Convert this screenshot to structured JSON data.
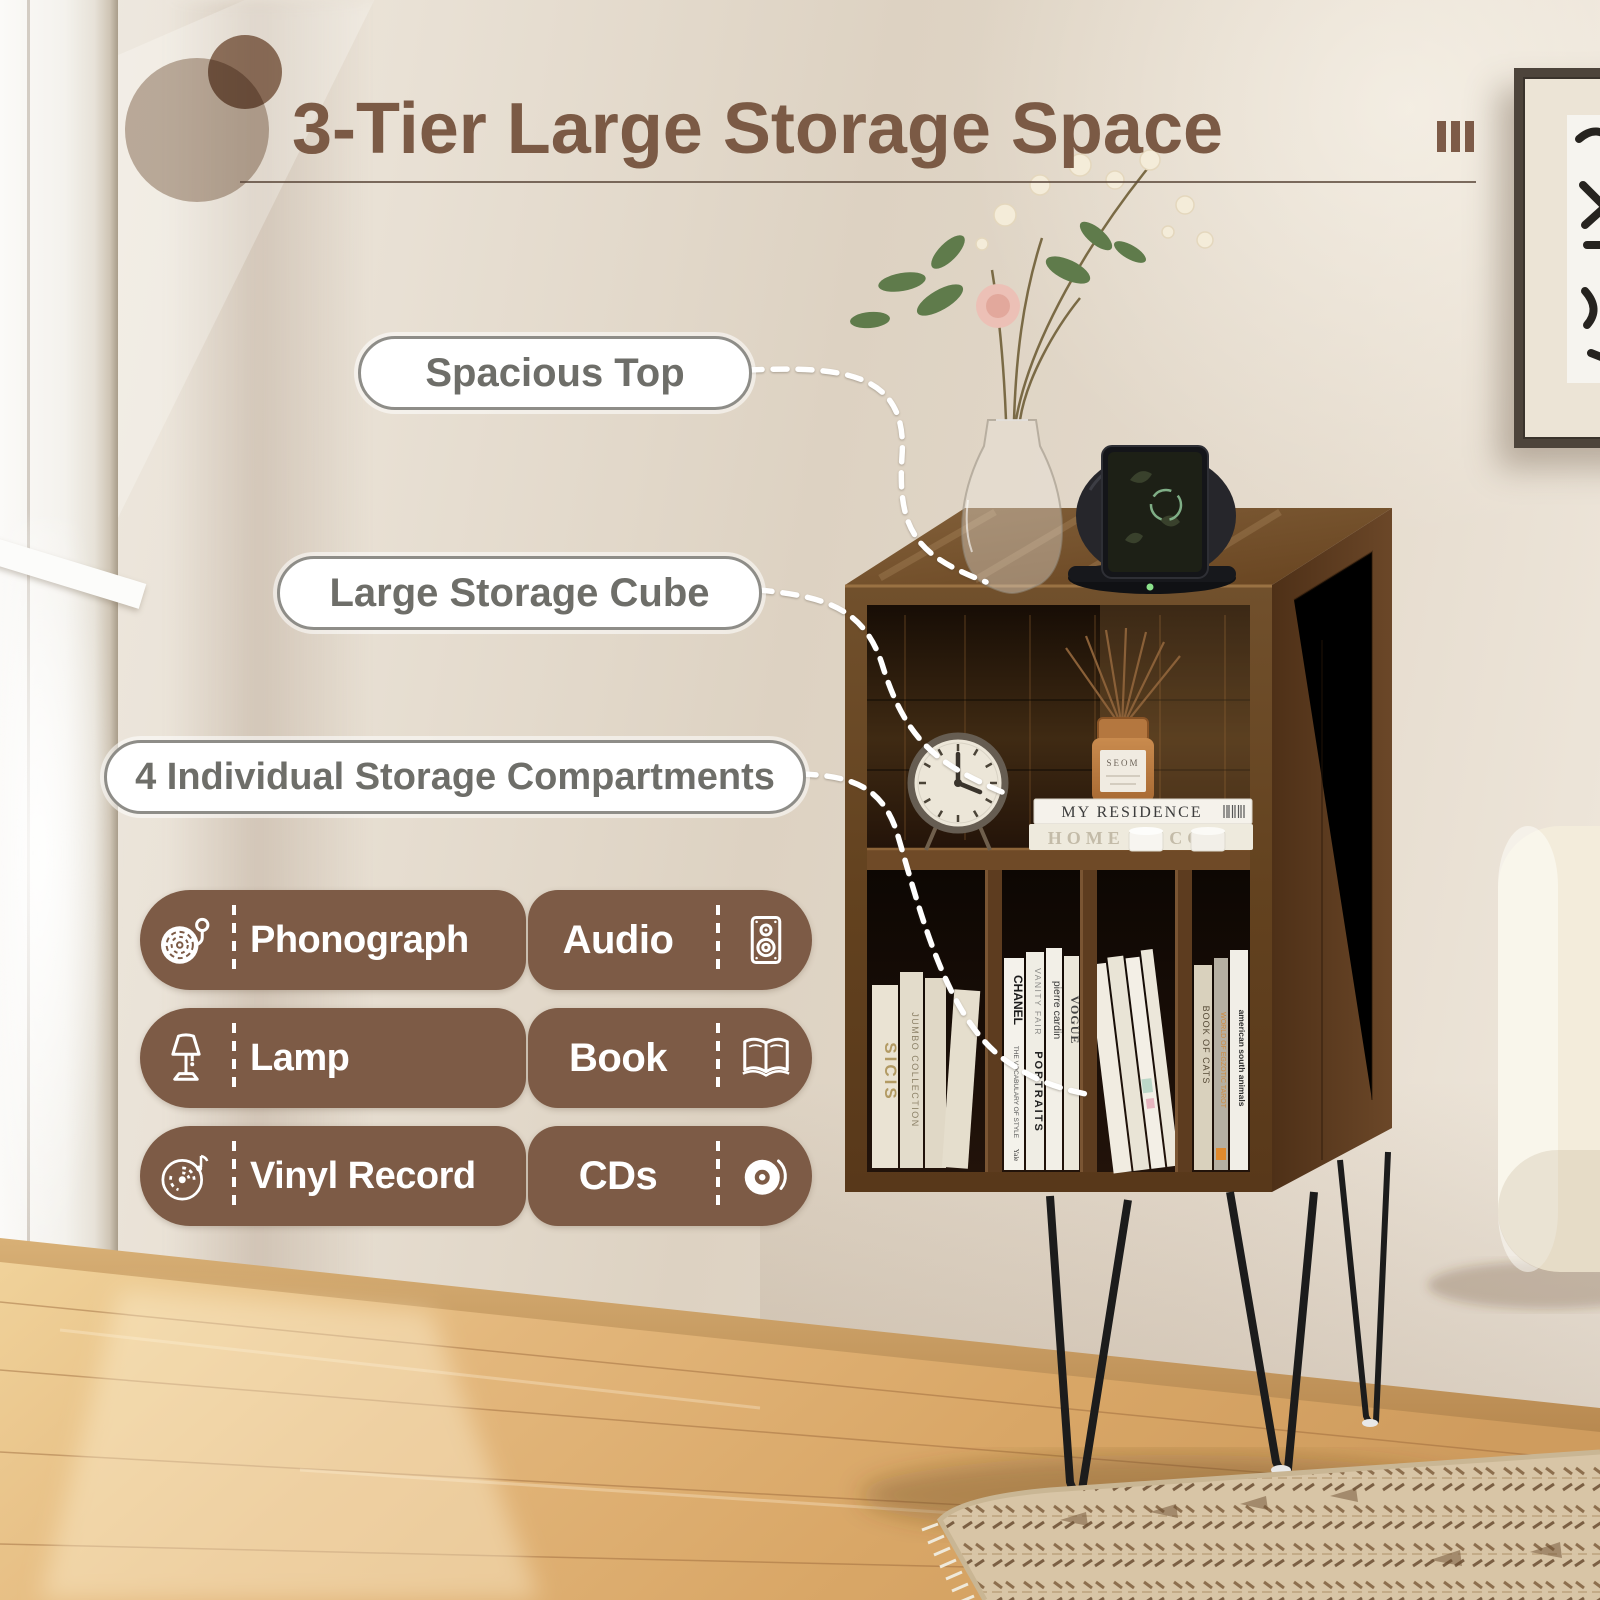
{
  "header": {
    "title": "3-Tier Large Storage Space"
  },
  "callouts": [
    {
      "label": "Spacious Top"
    },
    {
      "label": "Large Storage Cube"
    },
    {
      "label": "4 Individual Storage Compartments"
    }
  ],
  "features": [
    {
      "icon": "phonograph-icon",
      "label": "Phonograph"
    },
    {
      "icon": "speaker-icon",
      "label": "Audio"
    },
    {
      "icon": "lamp-icon",
      "label": "Lamp"
    },
    {
      "icon": "open-book-icon",
      "label": "Book"
    },
    {
      "icon": "vinyl-record-icon",
      "label": "Vinyl Record"
    },
    {
      "icon": "cd-icon",
      "label": "CDs"
    }
  ],
  "photo": {
    "book_stack_top": "MY RESIDENCE",
    "book_stack_bottom": "HOME DECOR",
    "diffuser_label": "SEOM",
    "spine_sicis": "SICIS",
    "spine_jumbo": "JUMBO COLLECTION",
    "spine_chanel": "CHANEL",
    "spine_chanel_sub": "THE VOCABULARY OF STYLE",
    "spine_chanel_pub": "Yale",
    "spine_vanity": "VANITY FAIR",
    "spine_portraits": "PORTRAITS",
    "spine_pierre": "pierre cardin",
    "spine_vogue": "VOGUE",
    "spine_cats": "BOOK OF CATS",
    "spine_tarot": "WORLD OF EGZOTIC TAROT",
    "spine_animals": "american south animals"
  },
  "colors": {
    "accent_brown": "#7b5a45",
    "badge_brown": "#7d5b46",
    "pill_border": "#8e8d88",
    "pill_text": "#6e6e69",
    "wall": "#e6dccf",
    "wood": "#6b4826",
    "wood_dark": "#57371c",
    "cabinet_interior": "#241409",
    "floor": "#e0b077",
    "sofa": "#f3ecdb",
    "rug": "#d8c5a6",
    "leg_black": "#1c1c1c",
    "connector_white": "#ffffff"
  }
}
